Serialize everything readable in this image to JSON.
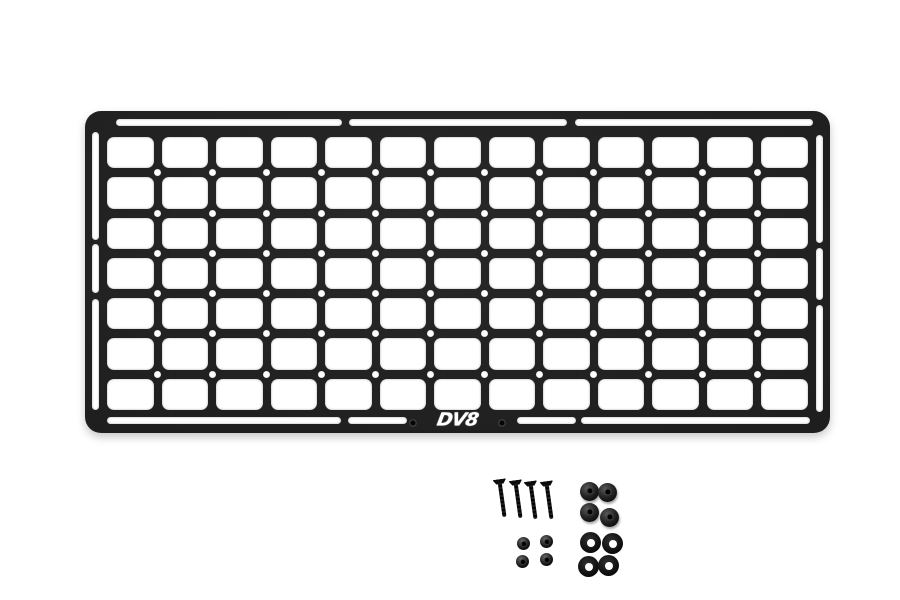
{
  "scene": {
    "type": "product-photo",
    "background_color": "#ffffff",
    "subject": "Black MOLLE rack panel with mounting hardware kit"
  },
  "panel": {
    "logo_text": "DV8",
    "body_color": "#1f1f1f",
    "cutout_color": "#ffffff",
    "grid": {
      "columns": 13,
      "rows": 7
    },
    "holes": {
      "rows": 6,
      "per_row": 12
    },
    "slot_counts": {
      "top": 3,
      "bottom": 4,
      "left": 3,
      "right": 3
    },
    "logo_side_holes": 2
  },
  "hardware": {
    "screws": 4,
    "spacers": 4,
    "nuts": 4,
    "washers": 4
  }
}
